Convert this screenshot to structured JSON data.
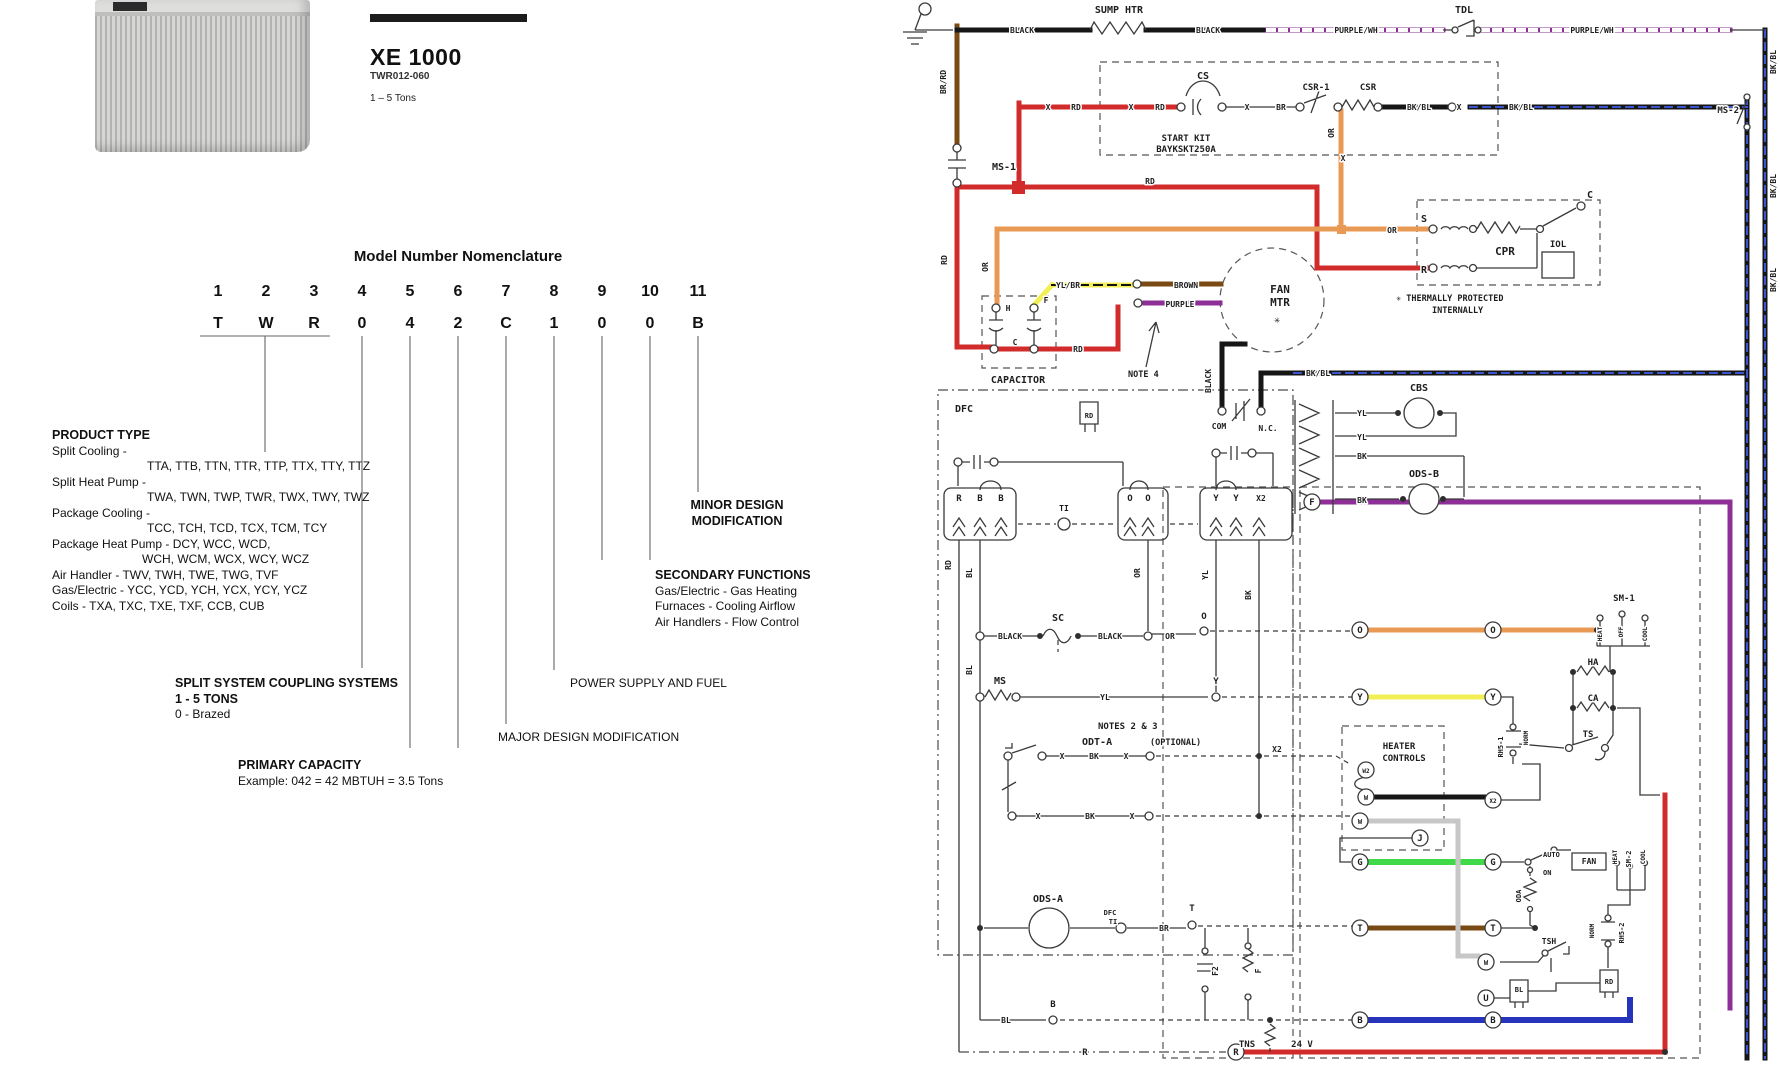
{
  "header": {
    "model": "XE 1000",
    "model_number": "TWR012-060",
    "tons": "1 – 5 Tons"
  },
  "nomenclature": {
    "title": "Model Number Nomenclature",
    "positions": [
      {
        "num": "1",
        "char": "T"
      },
      {
        "num": "2",
        "char": "W"
      },
      {
        "num": "3",
        "char": "R"
      },
      {
        "num": "4",
        "char": "0"
      },
      {
        "num": "5",
        "char": "4"
      },
      {
        "num": "6",
        "char": "2"
      },
      {
        "num": "7",
        "char": "C"
      },
      {
        "num": "8",
        "char": "1"
      },
      {
        "num": "9",
        "char": "0"
      },
      {
        "num": "10",
        "char": "0"
      },
      {
        "num": "11",
        "char": "B"
      }
    ],
    "product_type": {
      "title": "PRODUCT TYPE",
      "lines": [
        {
          "t": "Split Cooling -",
          "i": 0
        },
        {
          "t": "TTA, TTB, TTN, TTR, TTP, TTX, TTY, TTZ",
          "i": 1
        },
        {
          "t": "Split Heat Pump -",
          "i": 0
        },
        {
          "t": "TWA, TWN, TWP, TWR, TWX, TWY, TWZ",
          "i": 1
        },
        {
          "t": "Package Cooling -",
          "i": 0
        },
        {
          "t": "TCC, TCH, TCD, TCX, TCM, TCY",
          "i": 1
        },
        {
          "t": "Package Heat Pump - DCY, WCC, WCD,",
          "i": 0
        },
        {
          "t": "WCH, WCM, WCX, WCY, WCZ",
          "i": 2
        },
        {
          "t": "Air Handler - TWV, TWH, TWE, TWG, TVF",
          "i": 0
        },
        {
          "t": "Gas/Electric - YCC, YCD, YCH, YCX, YCY, YCZ",
          "i": 0
        },
        {
          "t": "Coils - TXA, TXC, TXE, TXF, CCB, CUB",
          "i": 0
        }
      ]
    },
    "minor": {
      "line1": "MINOR DESIGN",
      "line2": "MODIFICATION"
    },
    "secondary": {
      "title": "SECONDARY FUNCTIONS",
      "lines": [
        "Gas/Electric - Gas Heating",
        "Furnaces - Cooling Airflow",
        "Air Handlers - Flow Control"
      ]
    },
    "coupling": {
      "title": "SPLIT SYSTEM COUPLING SYSTEMS",
      "line1": "1 - 5 TONS",
      "line2": "0 - Brazed"
    },
    "power": "POWER SUPPLY AND FUEL",
    "major": "MAJOR DESIGN MODIFICATION",
    "primary": {
      "title": "PRIMARY CAPACITY",
      "example": "Example: 042 = 42 MBTUH = 3.5 Tons"
    }
  },
  "colors": {
    "red": "#d22b2b",
    "orange": "#e89a55",
    "yellow": "#f2ef54",
    "green": "#3fd94a",
    "blue": "#2633bb",
    "brown": "#7a4a15",
    "purple": "#8d2f96",
    "gray": "#c7c7c7",
    "black": "#161616"
  },
  "diagram": {
    "labels": [
      {
        "t": "BR/RD",
        "x": 946,
        "y": 82,
        "r": 1,
        "s": 8
      },
      {
        "t": "BLACK",
        "x": 1022,
        "y": 33,
        "s": 8
      },
      {
        "t": "SUMP HTR",
        "x": 1119,
        "y": 13,
        "s": 10
      },
      {
        "t": "BLACK",
        "x": 1208,
        "y": 33,
        "s": 8
      },
      {
        "t": "PURPLE/WH",
        "x": 1356,
        "y": 33,
        "s": 8
      },
      {
        "t": "TDL",
        "x": 1464,
        "y": 13,
        "s": 10
      },
      {
        "t": "PURPLE/WH",
        "x": 1592,
        "y": 33,
        "s": 8
      },
      {
        "t": "BK/BL",
        "x": 1776,
        "y": 62,
        "r": 1,
        "s": 8
      },
      {
        "t": "MS-2",
        "x": 1739,
        "y": 113,
        "a": "e",
        "s": 9
      },
      {
        "t": "BK/BL",
        "x": 1776,
        "y": 186,
        "r": 1,
        "s": 8
      },
      {
        "t": "BK/BL",
        "x": 1776,
        "y": 280,
        "r": 1,
        "s": 8
      },
      {
        "t": "CS",
        "x": 1203,
        "y": 79,
        "s": 10
      },
      {
        "t": "CSR-1",
        "x": 1316,
        "y": 90,
        "s": 9
      },
      {
        "t": "CSR",
        "x": 1368,
        "y": 90,
        "s": 9
      },
      {
        "t": "START KIT",
        "x": 1186,
        "y": 141,
        "s": 9
      },
      {
        "t": "BAYKSKT250A",
        "x": 1186,
        "y": 152,
        "s": 9
      },
      {
        "t": "X",
        "x": 1048,
        "y": 110,
        "s": 8
      },
      {
        "t": "RD",
        "x": 1076,
        "y": 110,
        "s": 8
      },
      {
        "t": "X",
        "x": 1131,
        "y": 110,
        "s": 8
      },
      {
        "t": "RD",
        "x": 1160,
        "y": 110,
        "s": 8
      },
      {
        "t": "X",
        "x": 1247,
        "y": 110,
        "s": 8
      },
      {
        "t": "BR",
        "x": 1281,
        "y": 110,
        "s": 8
      },
      {
        "t": "BK/BL",
        "x": 1419,
        "y": 110,
        "s": 8
      },
      {
        "t": "X",
        "x": 1459,
        "y": 110,
        "s": 8
      },
      {
        "t": "BK/BL",
        "x": 1521,
        "y": 110,
        "s": 8
      },
      {
        "t": "OR",
        "x": 1334,
        "y": 133,
        "r": 1,
        "s": 8
      },
      {
        "t": "X",
        "x": 1343,
        "y": 161,
        "s": 8
      },
      {
        "t": "MS-1",
        "x": 992,
        "y": 170,
        "a": "s",
        "s": 10
      },
      {
        "t": "RD",
        "x": 1150,
        "y": 184,
        "s": 8
      },
      {
        "t": "RD",
        "x": 947,
        "y": 260,
        "r": 1,
        "s": 8
      },
      {
        "t": "S",
        "x": 1424,
        "y": 222,
        "s": 10
      },
      {
        "t": "R",
        "x": 1424,
        "y": 273,
        "s": 10
      },
      {
        "t": "CPR",
        "x": 1505,
        "y": 255,
        "s": 11
      },
      {
        "t": "IOL",
        "x": 1558,
        "y": 247,
        "s": 9
      },
      {
        "t": "C",
        "x": 1590,
        "y": 198,
        "s": 10
      },
      {
        "t": "✳ THERMALLY PROTECTED",
        "x": 1396,
        "y": 301,
        "a": "s",
        "s": 8.5
      },
      {
        "t": "INTERNALLY",
        "x": 1432,
        "y": 313,
        "a": "s",
        "s": 8.5
      },
      {
        "t": "OR",
        "x": 988,
        "y": 267,
        "r": 1,
        "s": 8
      },
      {
        "t": "OR",
        "x": 1392,
        "y": 233,
        "s": 8
      },
      {
        "t": "YL/BR",
        "x": 1068,
        "y": 288,
        "s": 8
      },
      {
        "t": "BROWN",
        "x": 1186,
        "y": 288,
        "s": 8
      },
      {
        "t": "PURPLE",
        "x": 1180,
        "y": 307,
        "s": 8
      },
      {
        "t": "FAN",
        "x": 1280,
        "y": 293,
        "s": 11
      },
      {
        "t": "MTR",
        "x": 1280,
        "y": 306,
        "s": 11
      },
      {
        "t": "✳",
        "x": 1277,
        "y": 323,
        "s": 10
      },
      {
        "t": "H",
        "x": 1008,
        "y": 311,
        "s": 8
      },
      {
        "t": "F",
        "x": 1046,
        "y": 303,
        "s": 8
      },
      {
        "t": "C",
        "x": 1015,
        "y": 345,
        "s": 8
      },
      {
        "t": "RD",
        "x": 1078,
        "y": 352,
        "s": 8
      },
      {
        "t": "CAPACITOR",
        "x": 1018,
        "y": 383,
        "s": 10
      },
      {
        "t": "NOTE 4",
        "x": 1128,
        "y": 377,
        "a": "s",
        "s": 8.5
      },
      {
        "t": "BLACK",
        "x": 1211,
        "y": 381,
        "r": 1,
        "s": 8
      },
      {
        "t": "COM",
        "x": 1219,
        "y": 429,
        "s": 8
      },
      {
        "t": "N.C.",
        "x": 1268,
        "y": 431,
        "s": 8
      },
      {
        "t": "BK/BL",
        "x": 1318,
        "y": 376,
        "s": 8
      },
      {
        "t": "DFC",
        "x": 964,
        "y": 412,
        "s": 10
      },
      {
        "t": "RD",
        "x": 1089,
        "y": 418,
        "s": 7
      },
      {
        "t": "CBS",
        "x": 1419,
        "y": 391,
        "s": 10
      },
      {
        "t": "YL",
        "x": 1362,
        "y": 416,
        "s": 8
      },
      {
        "t": "YL",
        "x": 1362,
        "y": 440,
        "s": 8
      },
      {
        "t": "BK",
        "x": 1362,
        "y": 459,
        "s": 8
      },
      {
        "t": "BK",
        "x": 1362,
        "y": 503,
        "s": 8
      },
      {
        "t": "ODS-B",
        "x": 1424,
        "y": 477,
        "s": 10
      },
      {
        "t": "R",
        "x": 959,
        "y": 501,
        "s": 9
      },
      {
        "t": "B",
        "x": 980,
        "y": 501,
        "s": 9
      },
      {
        "t": "B",
        "x": 1001,
        "y": 501,
        "s": 9
      },
      {
        "t": "TI",
        "x": 1064,
        "y": 511,
        "s": 8
      },
      {
        "t": "O",
        "x": 1130,
        "y": 501,
        "s": 9
      },
      {
        "t": "O",
        "x": 1148,
        "y": 501,
        "s": 9
      },
      {
        "t": "Y",
        "x": 1216,
        "y": 501,
        "s": 9
      },
      {
        "t": "Y",
        "x": 1236,
        "y": 501,
        "s": 9
      },
      {
        "t": "X2",
        "x": 1261,
        "y": 501,
        "s": 8
      },
      {
        "t": "RD",
        "x": 951,
        "y": 565,
        "r": 1,
        "s": 8
      },
      {
        "t": "BL",
        "x": 972,
        "y": 573,
        "r": 1,
        "s": 8
      },
      {
        "t": "OR",
        "x": 1140,
        "y": 573,
        "r": 1,
        "s": 8
      },
      {
        "t": "YL",
        "x": 1208,
        "y": 575,
        "r": 1,
        "s": 8
      },
      {
        "t": "BK",
        "x": 1251,
        "y": 595,
        "r": 1,
        "s": 8
      },
      {
        "t": "SC",
        "x": 1058,
        "y": 621,
        "s": 10
      },
      {
        "t": "BLACK",
        "x": 1010,
        "y": 639,
        "s": 8
      },
      {
        "t": "BLACK",
        "x": 1110,
        "y": 639,
        "s": 8
      },
      {
        "t": "OR",
        "x": 1170,
        "y": 639,
        "s": 8
      },
      {
        "t": "O",
        "x": 1204,
        "y": 619,
        "s": 9
      },
      {
        "t": "MS",
        "x": 1000,
        "y": 684,
        "s": 10
      },
      {
        "t": "YL",
        "x": 1105,
        "y": 700,
        "s": 8
      },
      {
        "t": "Y",
        "x": 1216,
        "y": 684,
        "s": 9
      },
      {
        "t": "BL",
        "x": 972,
        "y": 670,
        "r": 1,
        "s": 8
      },
      {
        "t": "NOTES 2 & 3",
        "x": 1098,
        "y": 729,
        "a": "s",
        "s": 9
      },
      {
        "t": "ODT-A",
        "x": 1082,
        "y": 745,
        "a": "s",
        "s": 10
      },
      {
        "t": "(OPTIONAL)",
        "x": 1150,
        "y": 745,
        "a": "s",
        "s": 8.5
      },
      {
        "t": "X",
        "x": 1062,
        "y": 759,
        "s": 8
      },
      {
        "t": "BK",
        "x": 1094,
        "y": 759,
        "s": 8
      },
      {
        "t": "X",
        "x": 1126,
        "y": 759,
        "s": 8
      },
      {
        "t": "X2",
        "x": 1277,
        "y": 752,
        "s": 8
      },
      {
        "t": "X",
        "x": 1038,
        "y": 819,
        "s": 8
      },
      {
        "t": "BK",
        "x": 1090,
        "y": 819,
        "s": 8
      },
      {
        "t": "X",
        "x": 1132,
        "y": 819,
        "s": 8
      },
      {
        "t": "ODS-A",
        "x": 1048,
        "y": 902,
        "s": 10
      },
      {
        "t": "DFC",
        "x": 1110,
        "y": 915,
        "s": 7
      },
      {
        "t": "TI",
        "x": 1113,
        "y": 924,
        "s": 7
      },
      {
        "t": "BR",
        "x": 1164,
        "y": 931,
        "s": 8
      },
      {
        "t": "T",
        "x": 1192,
        "y": 911,
        "s": 9
      },
      {
        "t": "F",
        "x": 1312,
        "y": 502,
        "c": 7
      },
      {
        "t": "O",
        "x": 1360,
        "y": 630,
        "c": 7
      },
      {
        "t": "O",
        "x": 1493,
        "y": 630,
        "c": 7
      },
      {
        "t": "Y",
        "x": 1360,
        "y": 697,
        "c": 7
      },
      {
        "t": "Y",
        "x": 1493,
        "y": 697,
        "c": 7
      },
      {
        "t": "W2",
        "x": 1366,
        "y": 770,
        "c": 7,
        "s": 6
      },
      {
        "t": "W",
        "x": 1366,
        "y": 797,
        "c": 7,
        "s": 7
      },
      {
        "t": "X2",
        "x": 1493,
        "y": 800,
        "c": 7,
        "s": 6
      },
      {
        "t": "W",
        "x": 1360,
        "y": 821,
        "c": 7,
        "s": 7
      },
      {
        "t": "J",
        "x": 1420,
        "y": 838,
        "c": 7
      },
      {
        "t": "G",
        "x": 1360,
        "y": 862,
        "c": 7
      },
      {
        "t": "G",
        "x": 1493,
        "y": 862,
        "c": 7
      },
      {
        "t": "T",
        "x": 1360,
        "y": 928,
        "c": 7
      },
      {
        "t": "T",
        "x": 1493,
        "y": 928,
        "c": 7
      },
      {
        "t": "B",
        "x": 1360,
        "y": 1020,
        "c": 7
      },
      {
        "t": "B",
        "x": 1493,
        "y": 1020,
        "c": 7
      },
      {
        "t": "W",
        "x": 1486,
        "y": 962,
        "c": 7,
        "s": 7
      },
      {
        "t": "U",
        "x": 1486,
        "y": 998,
        "c": 7
      },
      {
        "t": "R",
        "x": 1236,
        "y": 1052,
        "c": 7
      },
      {
        "t": "B",
        "x": 1053,
        "y": 1007,
        "s": 9
      },
      {
        "t": "BL",
        "x": 1006,
        "y": 1023,
        "s": 8
      },
      {
        "t": "TNS",
        "x": 1247,
        "y": 1047,
        "s": 9
      },
      {
        "t": "24 V",
        "x": 1302,
        "y": 1047,
        "s": 9
      },
      {
        "t": "R",
        "x": 1085,
        "y": 1055,
        "s": 9
      },
      {
        "t": "F2",
        "x": 1218,
        "y": 971,
        "r": 1,
        "s": 8
      },
      {
        "t": "F",
        "x": 1261,
        "y": 971,
        "r": 1,
        "s": 8
      },
      {
        "t": "SM-1",
        "x": 1624,
        "y": 601,
        "s": 9
      },
      {
        "t": "HEAT",
        "x": 1602,
        "y": 634,
        "r": 1,
        "s": 6
      },
      {
        "t": "OFF",
        "x": 1623,
        "y": 632,
        "r": 1,
        "s": 6
      },
      {
        "t": "COOL",
        "x": 1647,
        "y": 634,
        "r": 1,
        "s": 6
      },
      {
        "t": "HA",
        "x": 1593,
        "y": 665,
        "s": 9
      },
      {
        "t": "CA",
        "x": 1593,
        "y": 701,
        "s": 9
      },
      {
        "t": "TS",
        "x": 1588,
        "y": 737,
        "s": 9
      },
      {
        "t": "RH5-1",
        "x": 1503,
        "y": 747,
        "r": 1,
        "s": 7
      },
      {
        "t": "NORM",
        "x": 1528,
        "y": 738,
        "r": 1,
        "s": 6
      },
      {
        "t": "HEATER",
        "x": 1399,
        "y": 749,
        "s": 9
      },
      {
        "t": "CONTROLS",
        "x": 1404,
        "y": 761,
        "s": 9
      },
      {
        "t": "AUTO",
        "x": 1543,
        "y": 857,
        "a": "s",
        "s": 7
      },
      {
        "t": "ON",
        "x": 1543,
        "y": 875,
        "a": "s",
        "s": 7
      },
      {
        "t": "FAN",
        "x": 1589,
        "y": 864,
        "s": 8
      },
      {
        "t": "HEAT",
        "x": 1617,
        "y": 857,
        "r": 1,
        "s": 6
      },
      {
        "t": "SM-2",
        "x": 1631,
        "y": 859,
        "r": 1,
        "s": 7
      },
      {
        "t": "COOL",
        "x": 1645,
        "y": 857,
        "r": 1,
        "s": 6
      },
      {
        "t": "ODA",
        "x": 1521,
        "y": 896,
        "r": 1,
        "s": 7
      },
      {
        "t": "NORM",
        "x": 1594,
        "y": 931,
        "r": 1,
        "s": 6
      },
      {
        "t": "RH5-2",
        "x": 1624,
        "y": 933,
        "r": 1,
        "s": 7
      },
      {
        "t": "TSH",
        "x": 1549,
        "y": 944,
        "s": 8
      },
      {
        "t": "BL",
        "x": 1519,
        "y": 992,
        "s": 7
      },
      {
        "t": "RD",
        "x": 1609,
        "y": 984,
        "s": 7
      }
    ]
  }
}
